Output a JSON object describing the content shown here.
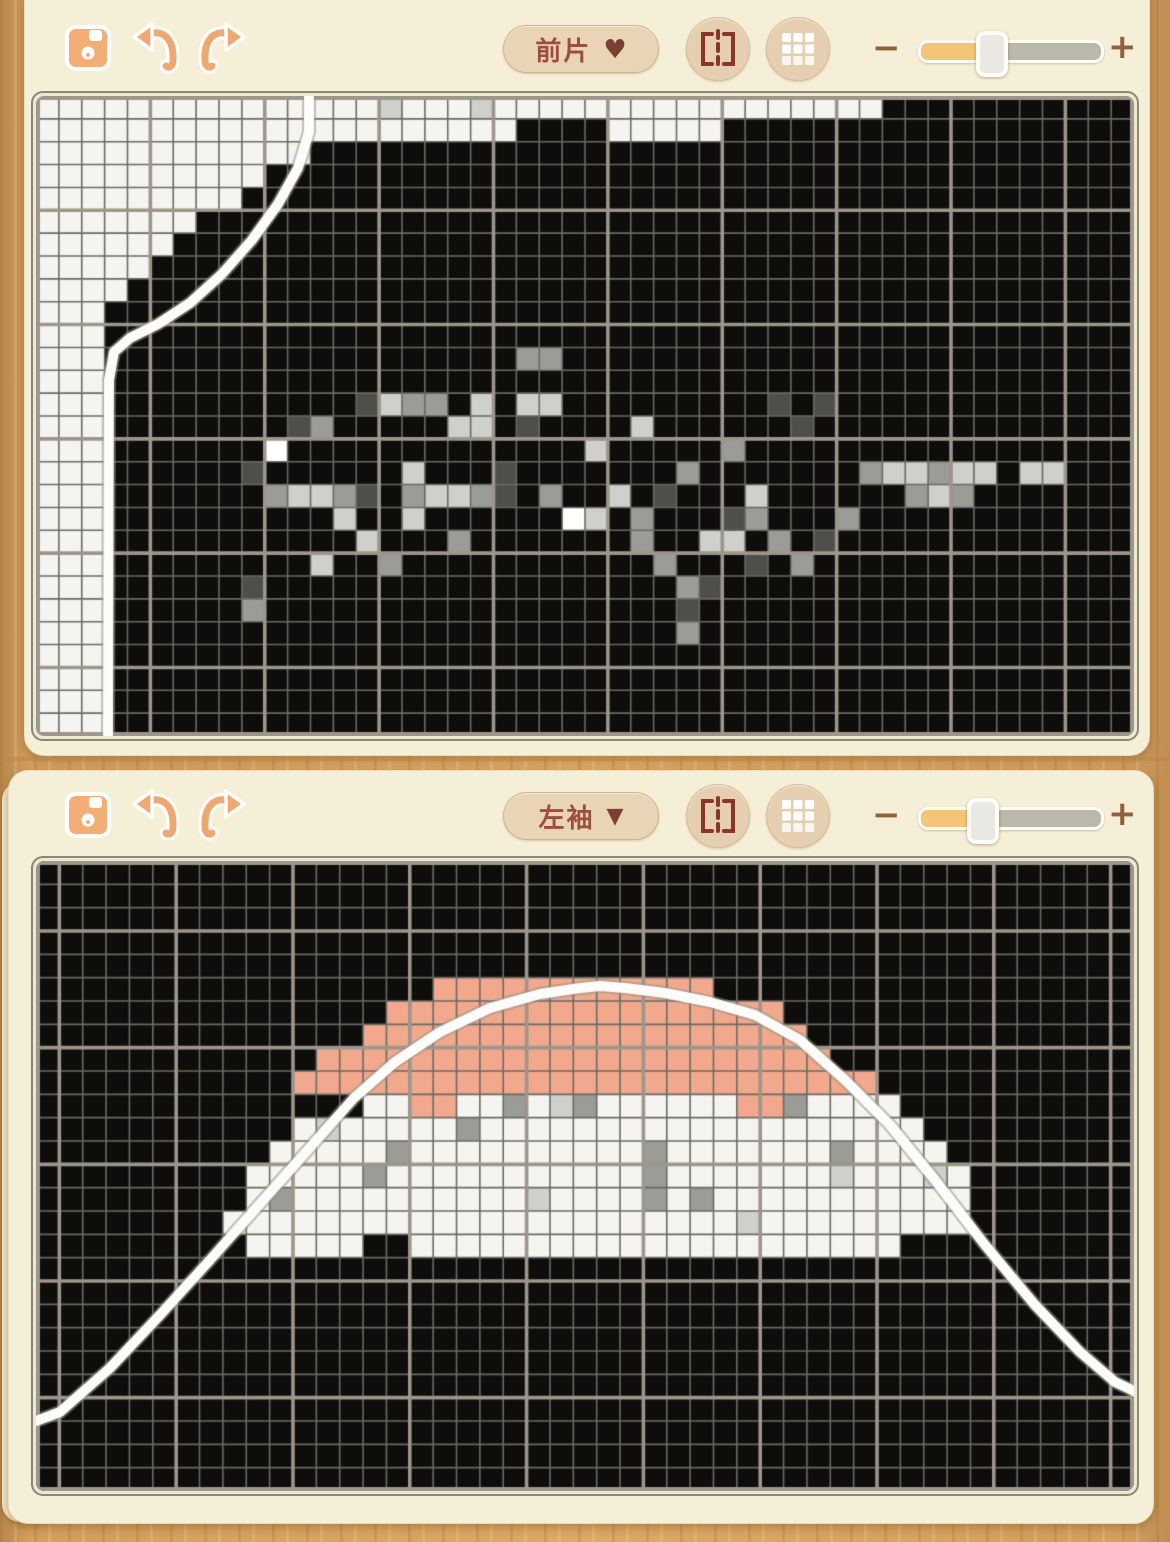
{
  "colors": {
    "card_bg": "#f6efd8",
    "wood": "#d3a05e",
    "cell_black": "#0e0d0b",
    "cell_white": "#f5f4f1",
    "cell_light": "#cfcfcc",
    "cell_mid": "#9b9b97",
    "cell_dark": "#4e4e4b",
    "cell_bright": "#ffffff",
    "cell_salmon": "#f1a88d",
    "grid_minor": "#6a6a64",
    "grid_major": "#9c968b",
    "curve": "#fcfcfa",
    "accent_orange": "#f2ae74",
    "icon_red": "#8a352a",
    "text_brown": "#9c4f3d",
    "slider_fill": "#f6c477",
    "slider_track": "#b9b8ab"
  },
  "panels": [
    {
      "name": "front-piece-panel",
      "toolbar": {
        "save_icon": "floppy-save-icon",
        "undo_icon": "undo-arrow-icon",
        "redo_icon": "redo-arrow-icon",
        "dropdown_label": "前片",
        "dropdown_arrow": "♥",
        "flip_button": "mirror-flip-icon",
        "grid_button": "grid-3x3-icon",
        "zoom_minus": "−",
        "zoom_plus": "+",
        "slider_value_pct": 37
      },
      "grid": {
        "cols": 48,
        "rows": 28,
        "white_runs": [
          [
            0,
            0,
            0,
            36
          ],
          [
            1,
            1,
            0,
            20
          ],
          [
            1,
            1,
            25,
            29
          ],
          [
            2,
            2,
            0,
            11
          ],
          [
            3,
            3,
            0,
            9
          ],
          [
            4,
            4,
            0,
            8
          ],
          [
            5,
            5,
            0,
            6
          ],
          [
            6,
            6,
            0,
            5
          ],
          [
            7,
            7,
            0,
            4
          ],
          [
            8,
            8,
            0,
            3
          ],
          [
            9,
            27,
            0,
            2
          ]
        ],
        "salmon_runs": [],
        "scatter": [
          [
            15,
            0,
            "L"
          ],
          [
            19,
            0,
            "L"
          ],
          [
            21,
            11,
            "M"
          ],
          [
            22,
            11,
            "M"
          ],
          [
            14,
            13,
            "D"
          ],
          [
            15,
            13,
            "L"
          ],
          [
            16,
            13,
            "M"
          ],
          [
            17,
            13,
            "M"
          ],
          [
            19,
            13,
            "L"
          ],
          [
            21,
            13,
            "L"
          ],
          [
            22,
            13,
            "L"
          ],
          [
            32,
            13,
            "D"
          ],
          [
            34,
            13,
            "D"
          ],
          [
            11,
            14,
            "D"
          ],
          [
            12,
            14,
            "M"
          ],
          [
            18,
            14,
            "L"
          ],
          [
            19,
            14,
            "L"
          ],
          [
            21,
            14,
            "D"
          ],
          [
            26,
            14,
            "L"
          ],
          [
            33,
            14,
            "D"
          ],
          [
            10,
            15,
            "W"
          ],
          [
            24,
            15,
            "L"
          ],
          [
            30,
            15,
            "M"
          ],
          [
            9,
            16,
            "D"
          ],
          [
            16,
            16,
            "L"
          ],
          [
            20,
            16,
            "D"
          ],
          [
            28,
            16,
            "M"
          ],
          [
            36,
            16,
            "M"
          ],
          [
            37,
            16,
            "L"
          ],
          [
            38,
            16,
            "L"
          ],
          [
            39,
            16,
            "M"
          ],
          [
            40,
            16,
            "L"
          ],
          [
            41,
            16,
            "L"
          ],
          [
            43,
            16,
            "L"
          ],
          [
            44,
            16,
            "L"
          ],
          [
            10,
            17,
            "M"
          ],
          [
            11,
            17,
            "L"
          ],
          [
            12,
            17,
            "L"
          ],
          [
            13,
            17,
            "M"
          ],
          [
            14,
            17,
            "D"
          ],
          [
            16,
            17,
            "M"
          ],
          [
            17,
            17,
            "L"
          ],
          [
            18,
            17,
            "L"
          ],
          [
            19,
            17,
            "M"
          ],
          [
            20,
            17,
            "D"
          ],
          [
            22,
            17,
            "M"
          ],
          [
            25,
            17,
            "L"
          ],
          [
            27,
            17,
            "D"
          ],
          [
            31,
            17,
            "L"
          ],
          [
            38,
            17,
            "M"
          ],
          [
            39,
            17,
            "L"
          ],
          [
            40,
            17,
            "M"
          ],
          [
            13,
            18,
            "L"
          ],
          [
            16,
            18,
            "L"
          ],
          [
            23,
            18,
            "W"
          ],
          [
            24,
            18,
            "L"
          ],
          [
            26,
            18,
            "M"
          ],
          [
            30,
            18,
            "D"
          ],
          [
            31,
            18,
            "M"
          ],
          [
            35,
            18,
            "M"
          ],
          [
            14,
            19,
            "L"
          ],
          [
            18,
            19,
            "M"
          ],
          [
            26,
            19,
            "M"
          ],
          [
            29,
            19,
            "L"
          ],
          [
            30,
            19,
            "L"
          ],
          [
            32,
            19,
            "M"
          ],
          [
            34,
            19,
            "D"
          ],
          [
            12,
            20,
            "L"
          ],
          [
            15,
            20,
            "M"
          ],
          [
            27,
            20,
            "M"
          ],
          [
            31,
            20,
            "D"
          ],
          [
            33,
            20,
            "M"
          ],
          [
            9,
            21,
            "D"
          ],
          [
            28,
            21,
            "M"
          ],
          [
            29,
            21,
            "D"
          ],
          [
            9,
            22,
            "M"
          ],
          [
            28,
            22,
            "D"
          ],
          [
            28,
            23,
            "M"
          ]
        ],
        "curve": [
          [
            273,
            -2
          ],
          [
            273,
            36
          ],
          [
            262,
            72
          ],
          [
            242,
            108
          ],
          [
            216,
            144
          ],
          [
            186,
            178
          ],
          [
            154,
            207
          ],
          [
            122,
            228
          ],
          [
            94,
            242
          ],
          [
            78,
            256
          ],
          [
            73,
            284
          ],
          [
            72,
            644
          ]
        ]
      }
    },
    {
      "name": "left-sleeve-panel",
      "toolbar": {
        "save_icon": "floppy-save-icon",
        "undo_icon": "undo-arrow-icon",
        "redo_icon": "redo-arrow-icon",
        "dropdown_label": "左袖",
        "dropdown_arrow": "▼",
        "flip_button": "mirror-flip-icon",
        "grid_button": "grid-3x3-icon",
        "zoom_minus": "−",
        "zoom_plus": "+",
        "slider_value_pct": 32
      },
      "grid": {
        "cols": 47,
        "rows": 27,
        "white_runs": [
          [
            10,
            10,
            14,
            36
          ],
          [
            11,
            11,
            11,
            37
          ],
          [
            12,
            12,
            10,
            38
          ],
          [
            13,
            13,
            9,
            39
          ],
          [
            14,
            14,
            9,
            39
          ],
          [
            15,
            15,
            8,
            39
          ],
          [
            16,
            16,
            9,
            36
          ]
        ],
        "salmon_runs": [
          [
            5,
            5,
            17,
            28
          ],
          [
            6,
            6,
            15,
            31
          ],
          [
            7,
            7,
            14,
            32
          ],
          [
            8,
            8,
            12,
            33
          ],
          [
            9,
            9,
            11,
            35
          ]
        ],
        "scatter": [
          [
            16,
            10,
            "S"
          ],
          [
            17,
            10,
            "S"
          ],
          [
            30,
            10,
            "S"
          ],
          [
            31,
            10,
            "S"
          ],
          [
            20,
            10,
            "M"
          ],
          [
            22,
            10,
            "L"
          ],
          [
            23,
            10,
            "M"
          ],
          [
            32,
            10,
            "M"
          ],
          [
            18,
            11,
            "M"
          ],
          [
            12,
            11,
            "L"
          ],
          [
            26,
            12,
            "M"
          ],
          [
            34,
            12,
            "M"
          ],
          [
            15,
            12,
            "M"
          ],
          [
            14,
            13,
            "M"
          ],
          [
            26,
            13,
            "M"
          ],
          [
            34,
            13,
            "L"
          ],
          [
            38,
            13,
            "L"
          ],
          [
            10,
            14,
            "M"
          ],
          [
            26,
            14,
            "M"
          ],
          [
            28,
            14,
            "M"
          ],
          [
            21,
            14,
            "L"
          ],
          [
            30,
            15,
            "L"
          ],
          [
            14,
            16,
            "K"
          ],
          [
            15,
            16,
            "K"
          ]
        ],
        "curve": [
          [
            0,
            560
          ],
          [
            24,
            551
          ],
          [
            74,
            507
          ],
          [
            124,
            454
          ],
          [
            174,
            399
          ],
          [
            222,
            345
          ],
          [
            270,
            291
          ],
          [
            318,
            237
          ],
          [
            359,
            201
          ],
          [
            404,
            171
          ],
          [
            454,
            147
          ],
          [
            504,
            133
          ],
          [
            544,
            127
          ],
          [
            564,
            125
          ],
          [
            589,
            127
          ],
          [
            629,
            132
          ],
          [
            674,
            141
          ],
          [
            719,
            154
          ],
          [
            764,
            179
          ],
          [
            809,
            219
          ],
          [
            854,
            264
          ],
          [
            899,
            319
          ],
          [
            949,
            384
          ],
          [
            999,
            444
          ],
          [
            1044,
            491
          ],
          [
            1079,
            521
          ],
          [
            1100,
            531
          ]
        ]
      }
    }
  ]
}
